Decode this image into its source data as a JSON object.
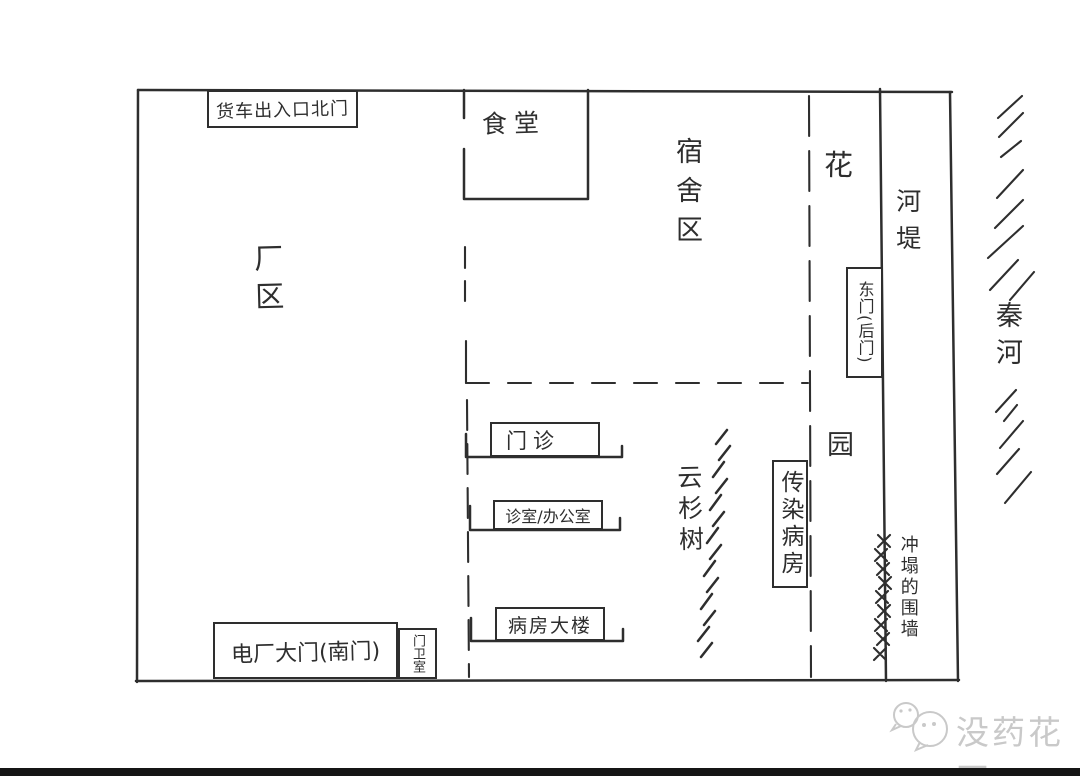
{
  "colors": {
    "ink": "#2e2e2e",
    "paper": "#ffffff",
    "watermark": "#c9c9c9",
    "footer_bar": "#151515"
  },
  "map": {
    "north_gate": "货车出入口北门",
    "canteen": "食堂",
    "factory_area": "厂区",
    "dormitory_area": "宿舍区",
    "flower": "花",
    "garden": "园",
    "river_embankment": "河堤",
    "east_gate": "东门(后门)",
    "qin_river": "秦河",
    "outpatient": "门诊",
    "clinic_office": "诊室/办公室",
    "ward_building": "病房大楼",
    "spruce_trees": "云杉树",
    "infectious_ward": "传染病房",
    "south_gate": "电厂大门(南门)",
    "guard_room": "门卫室",
    "collapsed_wall": "冲塌的围墙"
  },
  "watermark": {
    "text": "没药花园",
    "icon": "wechat-bubbles-icon"
  }
}
